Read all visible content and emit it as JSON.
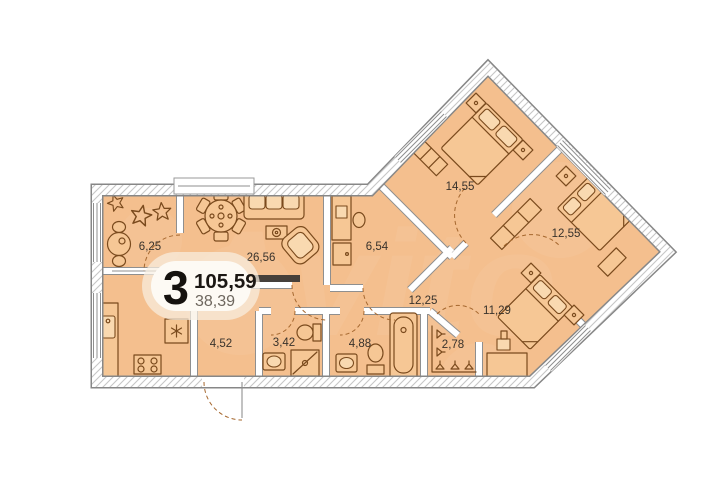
{
  "app": {
    "type": "apartment-floor-plan"
  },
  "badge": {
    "rooms_count": "3",
    "total_area_m2": "105,59",
    "living_area_m2": "38,39"
  },
  "rooms": [
    {
      "name": "loggia",
      "area_m2": "6,25"
    },
    {
      "name": "kitchen-living-room",
      "area_m2": "26,56"
    },
    {
      "name": "study",
      "area_m2": "6,54"
    },
    {
      "name": "bedroom-1",
      "area_m2": "14,55"
    },
    {
      "name": "bedroom-2",
      "area_m2": "12,55"
    },
    {
      "name": "bedroom-3",
      "area_m2": "11,29"
    },
    {
      "name": "hallway",
      "area_m2": "12,25"
    },
    {
      "name": "entry-hall",
      "area_m2": "4,52"
    },
    {
      "name": "shower-room",
      "area_m2": "3,42"
    },
    {
      "name": "bathroom",
      "area_m2": "4,88"
    },
    {
      "name": "wardrobe",
      "area_m2": "2,78"
    }
  ],
  "watermark": "Avito",
  "colors": {
    "background": "#ffffff",
    "floor_fill": "#f4bf8e",
    "wall_outline": "#8f8f8f",
    "wall_hatch": "#c6c6c6",
    "furniture_stroke": "#7a4a1d",
    "badge_background": "#fdfaf4",
    "label_text": "#38322b"
  }
}
